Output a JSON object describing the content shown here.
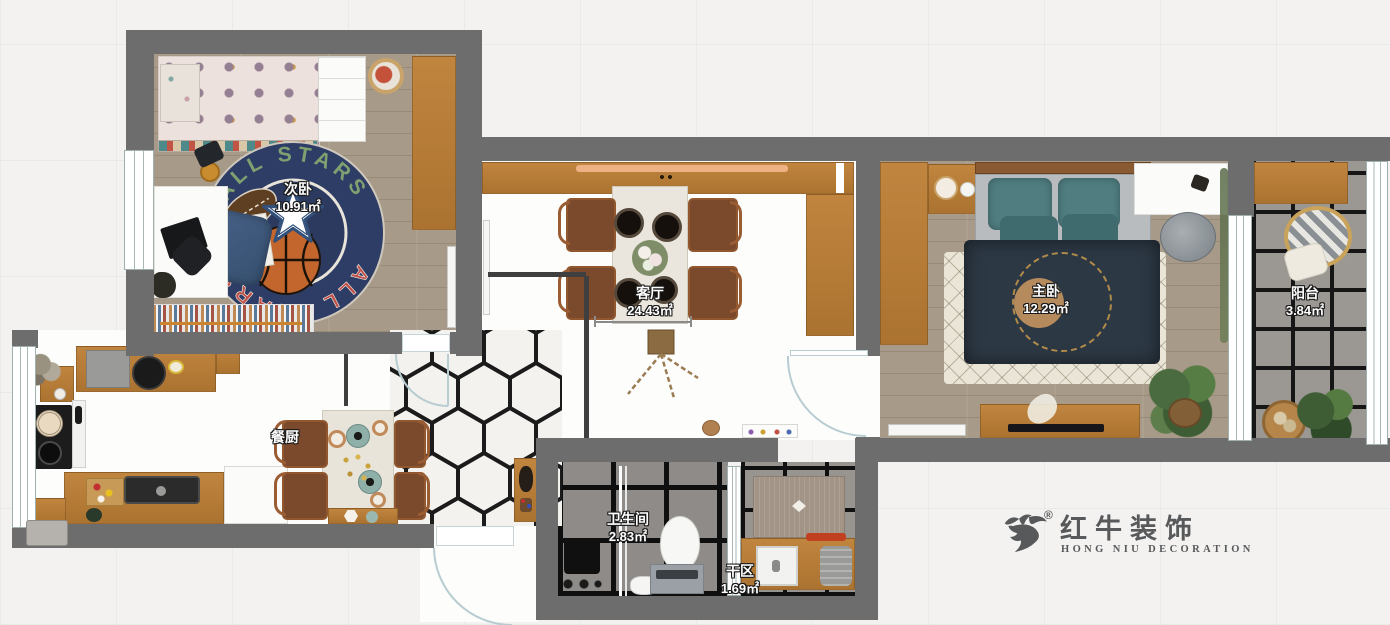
{
  "rooms": {
    "secondary_bedroom": {
      "name": "次卧",
      "area": "10.91㎡"
    },
    "living_room": {
      "name": "客厅",
      "area": "24.43㎡"
    },
    "master_bedroom": {
      "name": "主卧",
      "area": "12.29㎡"
    },
    "balcony": {
      "name": "阳台",
      "area": "3.84㎡"
    },
    "kitchen_dining": {
      "name": "餐厨"
    },
    "bathroom": {
      "name": "卫生间",
      "area": "2.83㎡"
    },
    "dry_area": {
      "name": "干区",
      "area": "1.69㎡"
    }
  },
  "logo": {
    "registered": "®",
    "brand": "红牛装饰",
    "subtitle": "HONG NIU DECORATION"
  },
  "rug": {
    "text_top": "ALL STARS",
    "text_bottom": "ALL STARS"
  },
  "colors": {
    "wall": "#6d6d6d",
    "wood": "#bc813c",
    "wood_floor": "#a79a88",
    "bath_tile": "#8e8b88",
    "balcony_tile": "#9b9792",
    "rug_navy": "#2e3d66",
    "bed_blanket": "#2c3844",
    "pillow_teal": "#4f7d80",
    "label_text": "#ffffff",
    "logo_gray": "#58595b",
    "door_arc": "#b8cdd1"
  }
}
